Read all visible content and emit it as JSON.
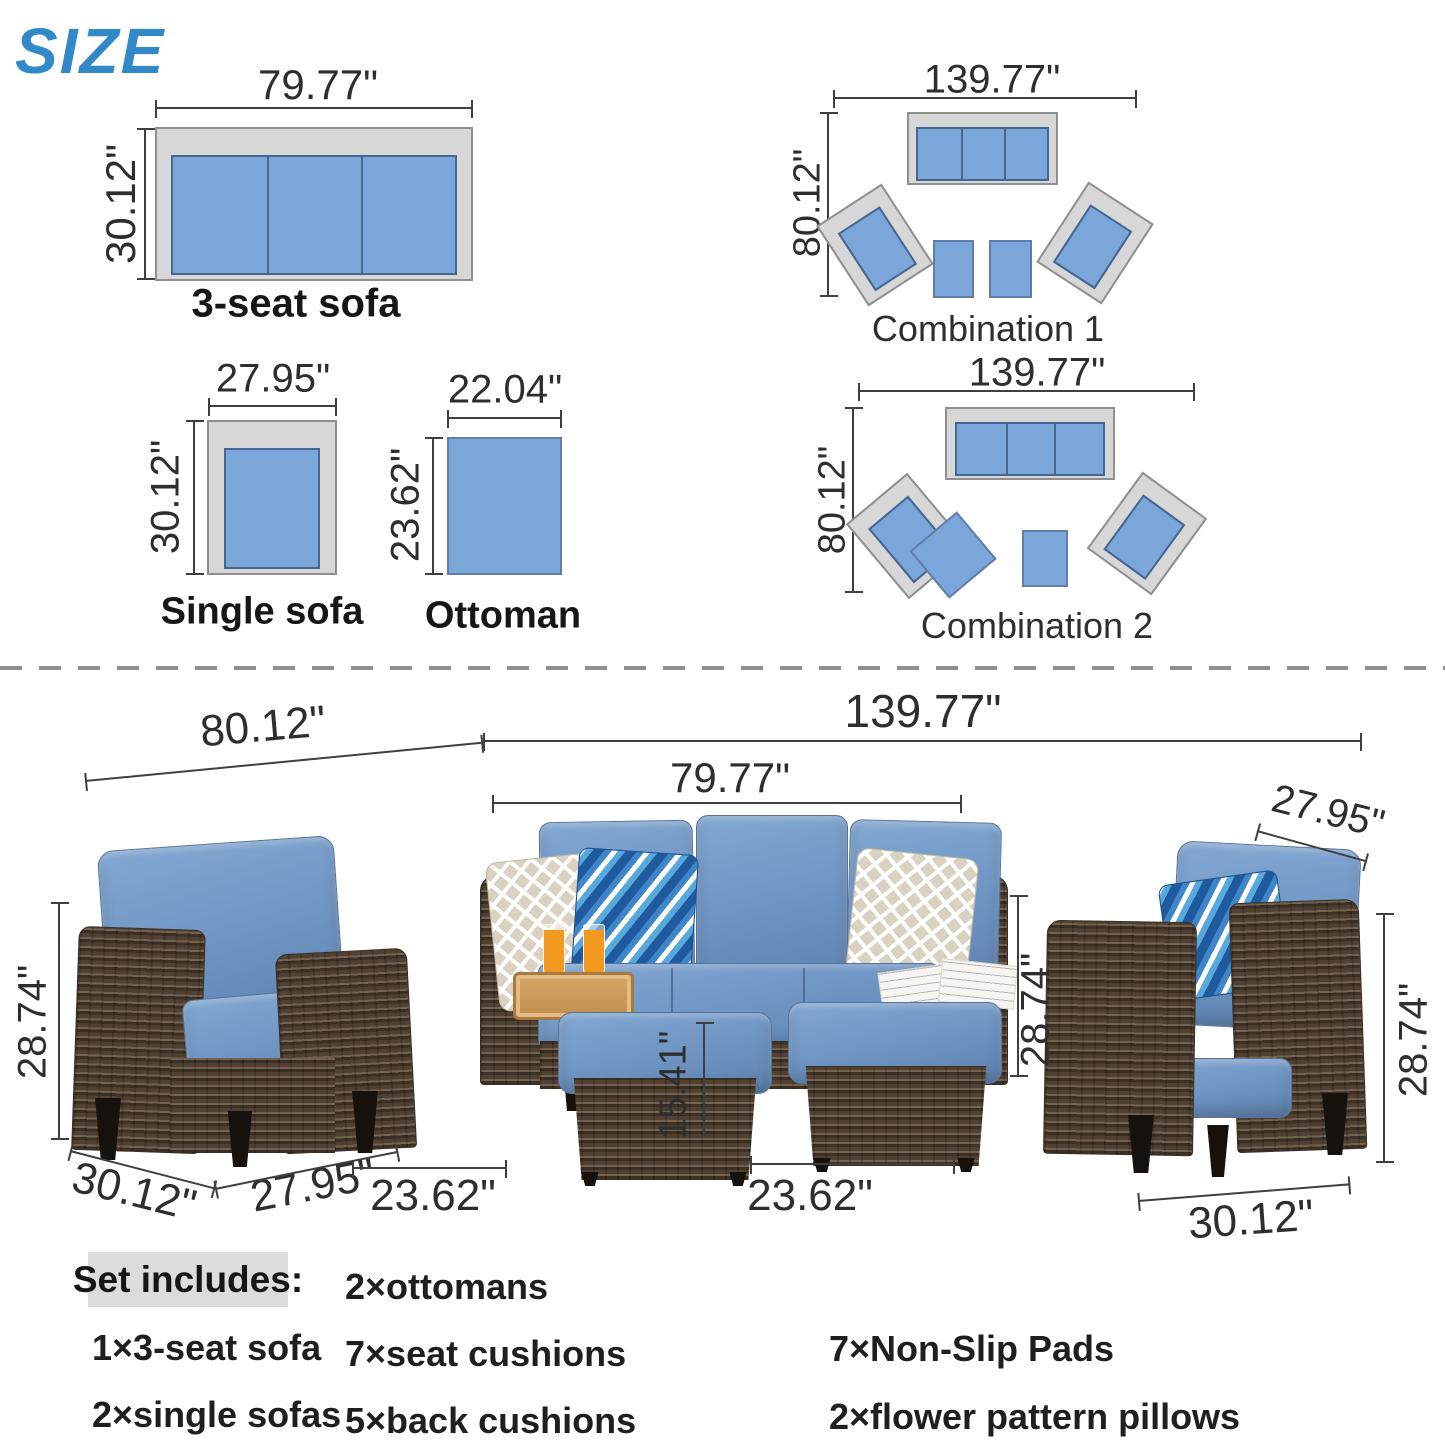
{
  "title": "SIZE",
  "colors": {
    "title_blue": "#3189c8",
    "diagram_cushion_blue": "#7ba6d9",
    "diagram_frame_gray": "#d7d7d7",
    "dimension_text": "#2e2e2e",
    "photo_cushion_blue": "#6e94c2",
    "wicker_brown": "#564739",
    "highlight_gray": "#dcdcdc"
  },
  "top": {
    "sofa3": {
      "width": "79.77\"",
      "depth": "30.12\"",
      "label": "3-seat sofa"
    },
    "single": {
      "width": "27.95\"",
      "depth": "30.12\"",
      "label": "Single sofa"
    },
    "ottoman": {
      "width": "22.04\"",
      "depth": "23.62\"",
      "label": "Ottoman"
    },
    "combo1": {
      "width": "139.77\"",
      "depth": "80.12\"",
      "label": "Combination 1"
    },
    "combo2": {
      "width": "139.77\"",
      "depth": "80.12\"",
      "label": "Combination 2"
    }
  },
  "photo": {
    "set_depth": "80.12\"",
    "set_width": "139.77\"",
    "sofa_width": "79.77\"",
    "sofa_height": "28.74\"",
    "chair_right_width": "27.95\"",
    "chair_right_height": "28.74\"",
    "chair_right_depth": "30.12\"",
    "chair_left_height": "28.74\"",
    "chair_left_depth": "30.12\"",
    "chair_left_width": "27.95\"",
    "ottoman_left_width": "23.62\"",
    "ottoman_right_width": "23.62\"",
    "ottoman_height": "15.41\""
  },
  "set_includes": {
    "heading": "Set includes:",
    "col1": [
      "1×3-seat sofa",
      "2×single sofas"
    ],
    "col2": [
      "2×ottomans",
      "7×seat cushions",
      "5×back cushions"
    ],
    "col3": [
      "7×Non-Slip Pads",
      "2×flower pattern pillows"
    ]
  }
}
